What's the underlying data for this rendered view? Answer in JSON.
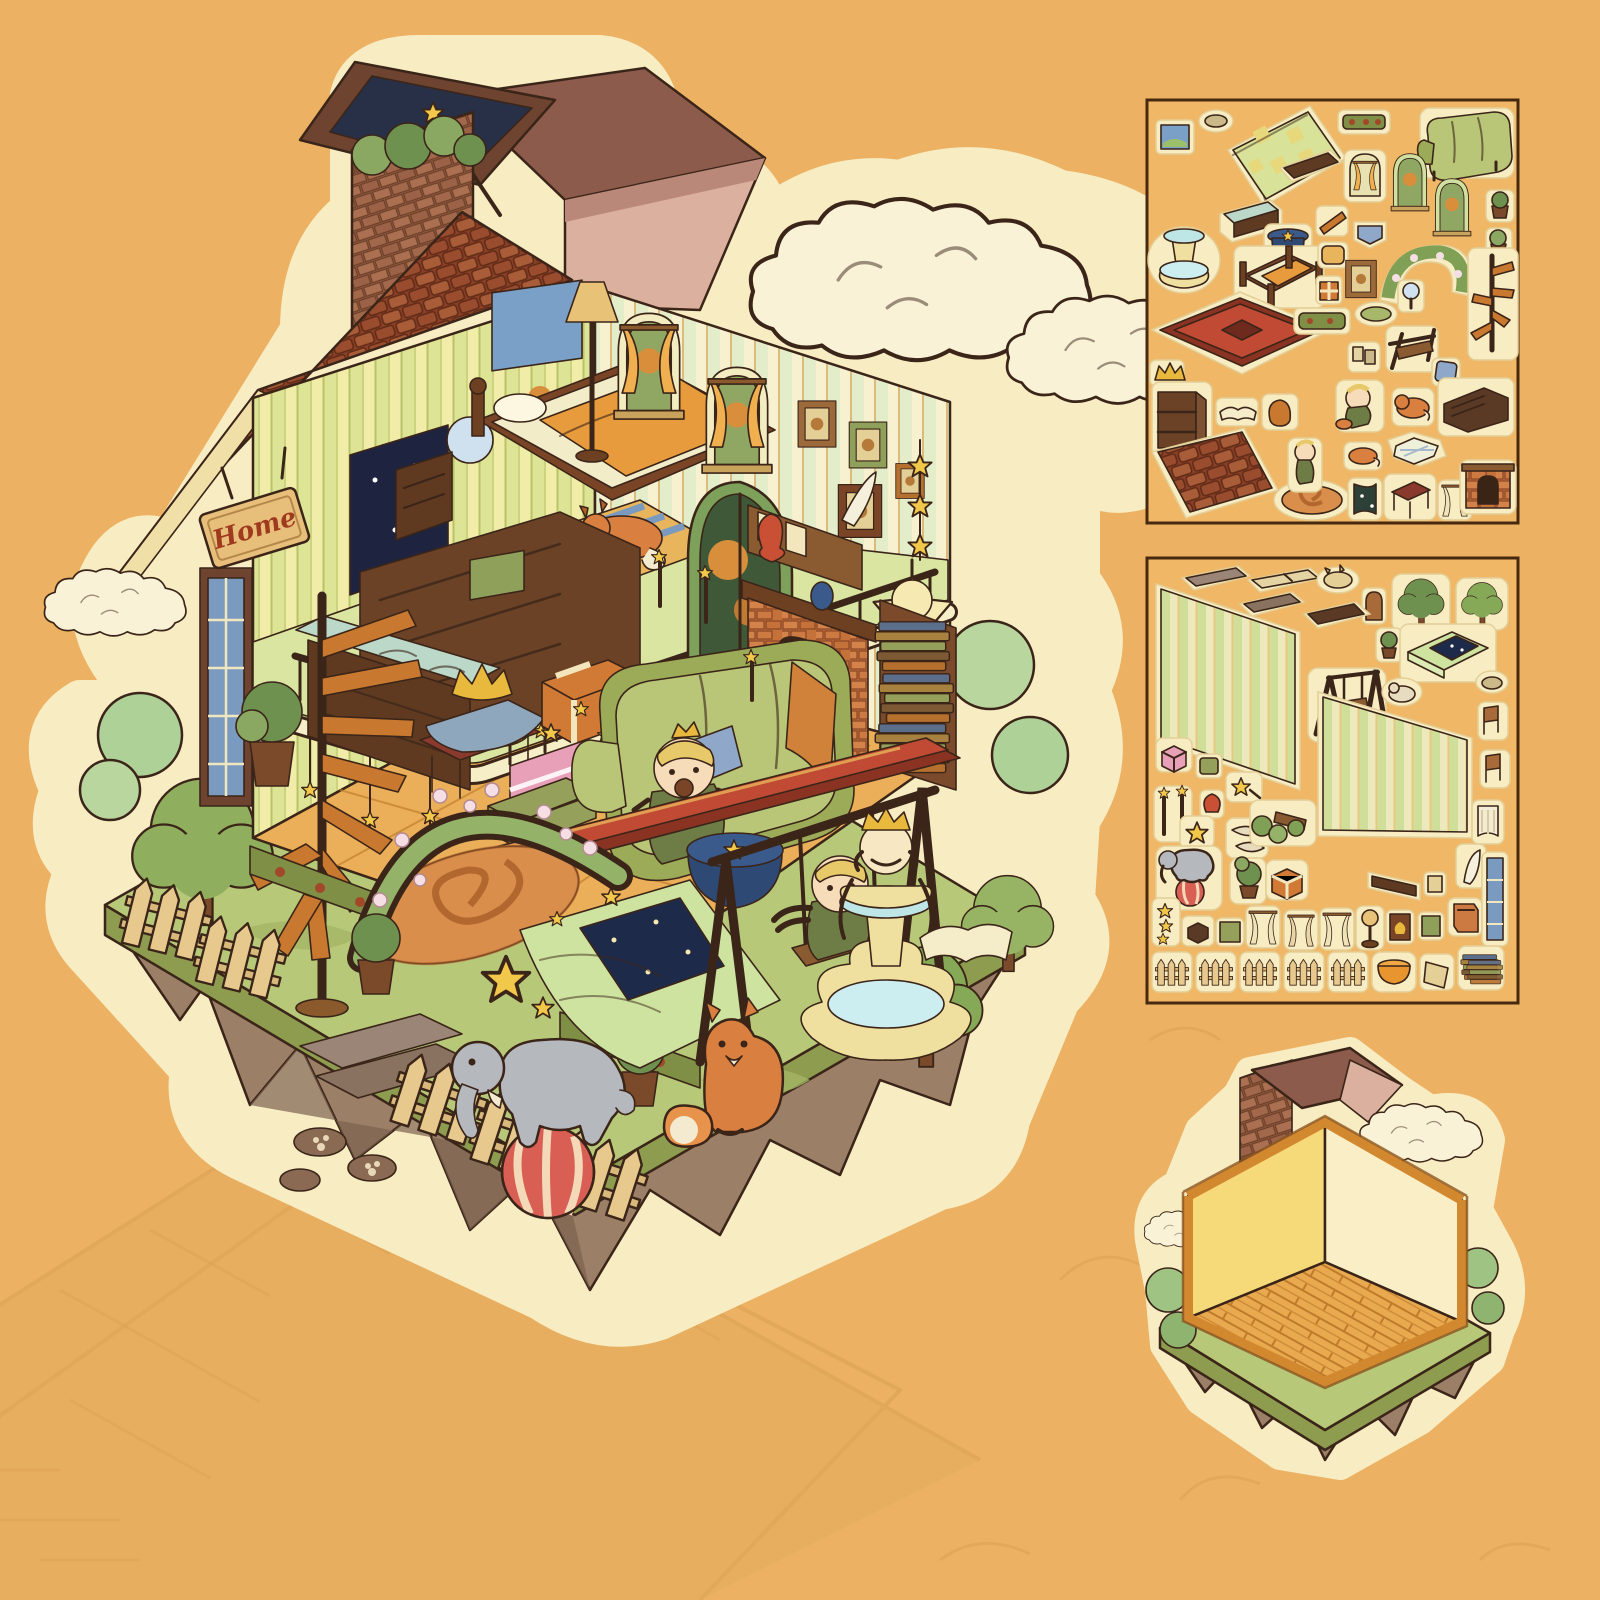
{
  "page": {
    "background_color": "#ecb162",
    "sticker_cream": "#f8ecc3",
    "sheet_border_color": "#46290f"
  },
  "colors": {
    "roof_shingle": "#9a4c2e",
    "chimney_brick": "#9a6147",
    "gable_pink": "#dcb09e",
    "wood_frame": "#c9882f",
    "wallpaper_left": "#eef0ae",
    "wallpaper_right": "#f7f1d0",
    "loft_floor": "#d9e5a0",
    "wood_floor": "#ecaf59",
    "sofa_green": "#b9c677",
    "carpet_red": "#c04a33",
    "grass": "#b7c979",
    "grass_band": "#8e9c4f",
    "island_rock": "#9b7f66",
    "fountain_blue": "#bfe6e6",
    "cloud_cream": "#f9f2d6"
  },
  "main_sticker": {
    "home_sign_text": "Home",
    "elements": [
      "tiled-roof",
      "brick-chimney",
      "skylight-window",
      "roof-planter",
      "pink-gable",
      "clouds",
      "striped-wallpaper",
      "starry-window",
      "wall-clock",
      "fox-painting",
      "wooden-bed",
      "nightstand",
      "floor-lamp",
      "sleeping-fox-on-rug",
      "arched-windows",
      "balcony-railing",
      "round-table-tablecloth",
      "wooden-chair",
      "star-garlands",
      "home-sign",
      "spiral-staircase",
      "stained-glass-door",
      "sideboard",
      "display-cabinet",
      "crown-stool",
      "gift-boxes",
      "green-sofa",
      "little-prince-doll",
      "blue-pillow",
      "picture-wall",
      "arched-garden-door",
      "fireplace",
      "mantel-vase",
      "book-shelf",
      "star-lamp",
      "red-carpet",
      "rose-arch",
      "rose-rug",
      "starry-quilt",
      "swing-with-boy",
      "blue-side-table",
      "king-fountain",
      "elephant-on-ball",
      "fox",
      "picket-fence",
      "garden-trees",
      "stone-path",
      "paw-stones",
      "floating-island"
    ]
  },
  "sheet1": {
    "items": [
      "framed-picture",
      "moss-scrap",
      "checkered-mattress",
      "flower-hedge",
      "green-sofa",
      "wood-plank",
      "curtain-window",
      "arch-window-a",
      "arch-window-b",
      "potted-plant-a",
      "display-shelf",
      "fountain",
      "magic-hat-table",
      "wood-ladder",
      "blue-pennant",
      "flower-arch",
      "potted-plant-b",
      "wooden-bed",
      "cushion",
      "framed-picture-b",
      "gift-box",
      "hand-mirror",
      "spiral-staircase",
      "red-rug",
      "hedge-strip",
      "moss-b",
      "towel-rack",
      "paper-scrap",
      "crown",
      "blue-pillow",
      "dark-dresser",
      "bookcase",
      "open-book",
      "wood-scrap",
      "prince-with-fox",
      "sleeping-fox",
      "star-rug",
      "roof-shingle-strip",
      "rose-rug",
      "prince-standing",
      "lying-fox",
      "starry-curtain",
      "red-stool",
      "cream-curtain",
      "fireplace"
    ]
  },
  "sheet2": {
    "items": [
      "stone-plank-a",
      "stone-plank-b",
      "window-frame",
      "cat-scrap",
      "arch-door",
      "tree-a",
      "tree-b",
      "door-mat",
      "potted-sapling",
      "starry-green-bed",
      "wallpaper-panel-a",
      "wooden-swing",
      "goat-scrap",
      "paw-scrap",
      "chair-a",
      "pink-gift-box",
      "green-book",
      "chair-b",
      "wallpaper-panel-b",
      "candlesticks",
      "red-vase",
      "shooting-star",
      "star-cookie",
      "banana-scrap",
      "flower-bench",
      "lace-curtain",
      "elephant-on-ball",
      "potted-topiary",
      "gift-box",
      "wall-shelf",
      "feather-quill",
      "small-frame",
      "teal-window",
      "star-strip",
      "wooden-cube",
      "framed-art-a",
      "curtain-a",
      "curtain-b",
      "curtain-c",
      "tree-lamp",
      "fire-painting",
      "framed-art-b",
      "orange-book",
      "fence-a",
      "fence-b",
      "fence-c",
      "fence-d",
      "fence-e",
      "round-ottoman",
      "sign-scrap",
      "book-stack-a",
      "book-stack-b"
    ]
  },
  "empty_room": {
    "elements": [
      "brick-chimney",
      "dormer-roof",
      "pink-gable",
      "bare-walls",
      "wooden-floor",
      "floating-island",
      "bushes",
      "clouds"
    ]
  }
}
